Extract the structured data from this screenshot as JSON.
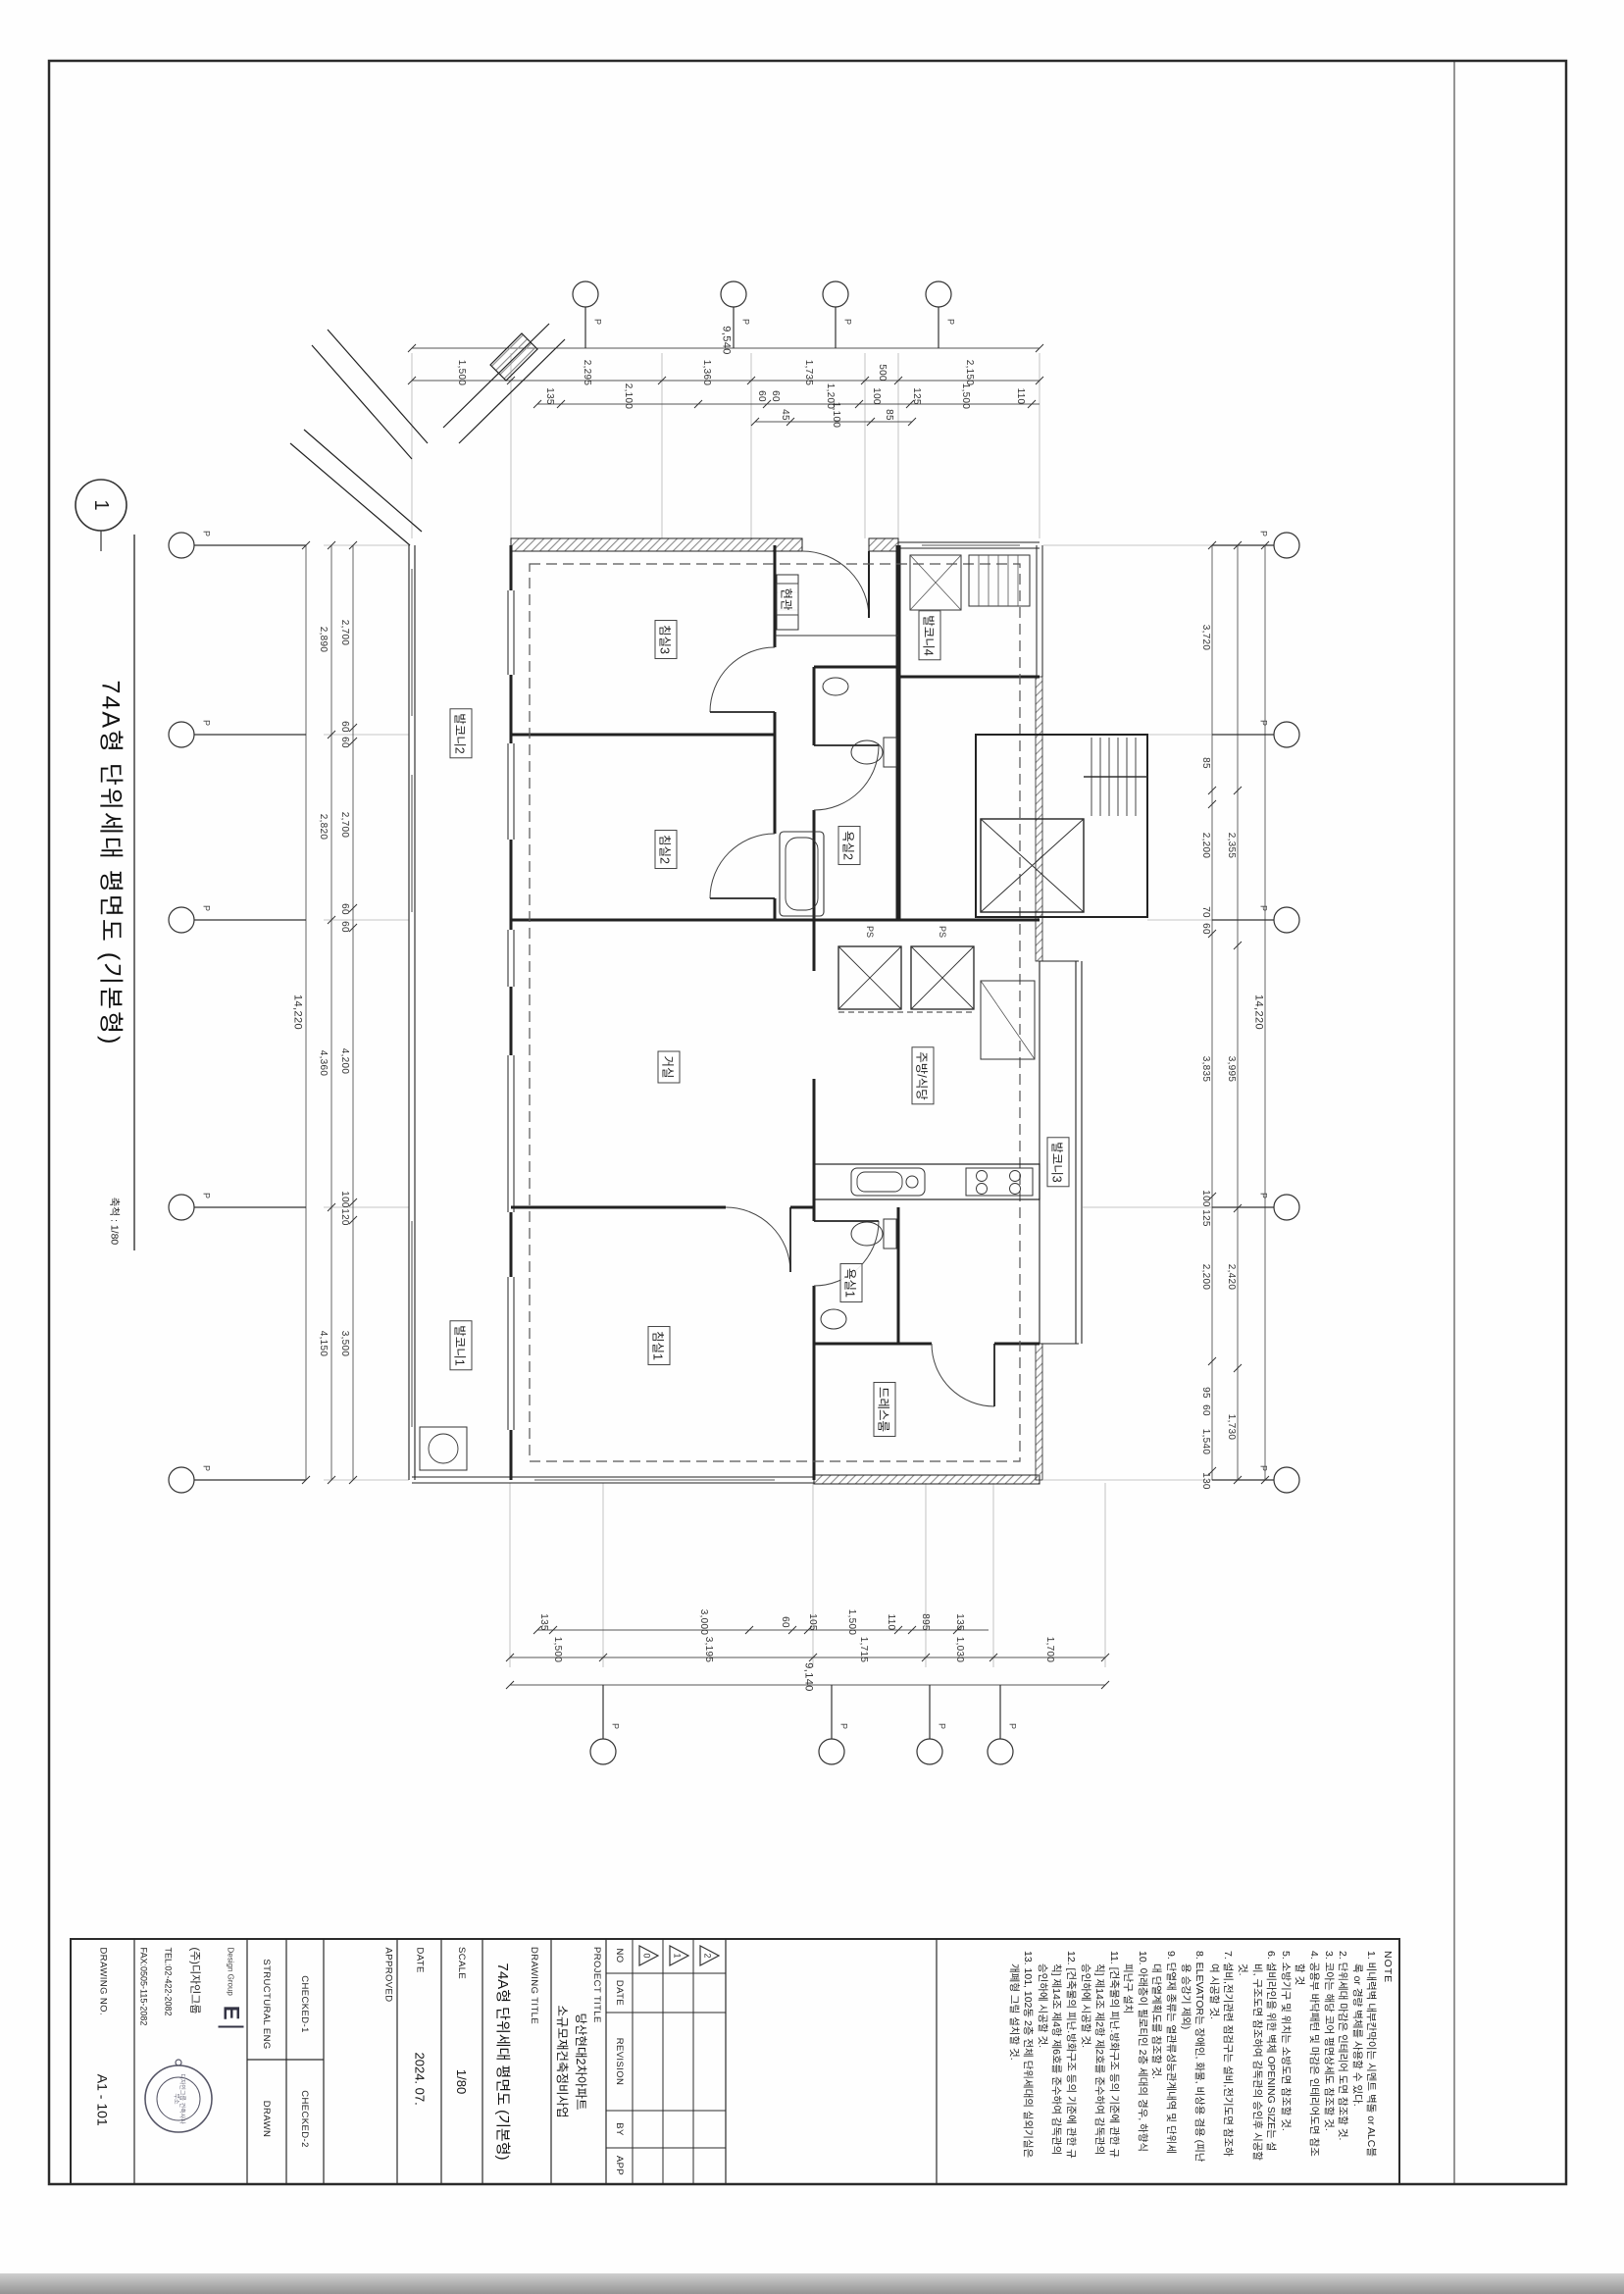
{
  "figure": {
    "number": "1",
    "title": "74A형 단위세대 평면도 (기본형)",
    "scale_note": "축척 : 1/80"
  },
  "grid": {
    "bubble_label": "P"
  },
  "rooms": [
    "침실3",
    "침실2",
    "거실",
    "침실1",
    "현관",
    "발코니4",
    "욕실2",
    "주방/식당",
    "발코니3",
    "욕실1",
    "드레스룸",
    "발코니2",
    "발코니1",
    "PS",
    "PS"
  ],
  "dims": {
    "t1": [
      "9,540"
    ],
    "t2": [
      "1,500",
      "2,295",
      "1,360",
      "1,735",
      "500",
      "2,150"
    ],
    "t3": [
      "135",
      "2,100",
      "60",
      "60",
      "1,200",
      "100",
      "125",
      "1,500",
      "110"
    ],
    "t4": [
      "45",
      "1,100",
      "85"
    ],
    "lt": [
      "14,220"
    ],
    "lo": [
      "2,890",
      "2,820",
      "4,360",
      "4,150"
    ],
    "li": [
      "2,700",
      "60",
      "60",
      "2,700",
      "60",
      "60",
      "4,200",
      "100",
      "120",
      "3,500"
    ],
    "rt": [
      "14,220"
    ],
    "ro": [
      "2,355",
      "3,995",
      "2,420",
      "1,730"
    ],
    "ri": [
      "3,720",
      "85",
      "2,200",
      "70",
      "60",
      "3,835",
      "100",
      "125",
      "2,200",
      "95",
      "60",
      "1,540",
      "130"
    ],
    "b1": [
      "135",
      "3,000",
      "60",
      "105",
      "1,500",
      "110",
      "895",
      "135"
    ],
    "b2": [
      "1,500",
      "3,195",
      "1,715",
      "1,030",
      "1,700"
    ],
    "b3": [
      "9,140"
    ]
  },
  "title_block": {
    "drawing_no_label": "DRAWING NO.",
    "drawing_no": "A1 - 101",
    "company": {
      "group_small": "Design Group",
      "logo": "E",
      "name": "(주)디자인그룹",
      "tel": "TEL:02-422-2082",
      "fax": "FAX:0505-115-2082",
      "stamp": "디자인그룹 건축사사무소"
    },
    "structural_label": "STRUCTURAL ENG",
    "drawn_label": "DRAWN",
    "checked1_label": "CHECKED-1",
    "checked2_label": "CHECKED-2",
    "approved_label": "APPROVED",
    "date_label": "DATE",
    "date_value": "2024. 07.",
    "scale_label": "SCALE",
    "scale_value": "1/80",
    "drawing_title_label": "DRAWING TITLE",
    "drawing_title": "74A형 단위세대 평면도 (기본형)",
    "project_title_label": "PROJECT TITLE",
    "project_title_line1": "당산현대2차아파트",
    "project_title_line2": "소규모재건축정비사업",
    "revision": {
      "no": "NO",
      "date": "DATE",
      "revision": "REVISION",
      "by": "BY",
      "app": "APP",
      "marks": [
        "0",
        "1",
        "2"
      ]
    }
  },
  "notes": {
    "header": "NOTE",
    "items": [
      "1. 비내력벽 내부칸막이는 시멘트 벽돌 or ALC블록 or 경량 벽체를 사용할 수 있다.",
      "2. 단위세대 마감은 인테리어 도면 참조할 것.",
      "3. 코아는 해당 코어 평면상세도 참조할 것.",
      "4. 공용부 바닥패턴 및 마감은 인테리어도면 참조할 것",
      "5. 소방기구 및 위치는 소방도면 참조할 것.",
      "6. 설비라인을 위한 벽체 OPENING SIZE는 설비, 구조도면 참조하여 감독관의 승인후 시공할 것.",
      "7. 설비,전기관련 점검구는 설비,전기도면 참조하여 시공할 것.",
      "8. ELEVATOR는 장애인, 화물, 비상용 겸용 (피난용 승강기 제외)",
      "9. 단열재 종류는 열관류성능관계내역 및 단위세대 단열계획도를 참조할 것.",
      "10. 아래층이 필로티인 2층 세대의 경우, 하향식 피난구 설치",
      "11. [건축물의 피난.방화구조 등의 기준에 관한 규칙] 제14조 제2항 제2호를 준수하여 감독관의 승인하에 시공할 것.",
      "12. [건축물의 피난.방화구조 등의 기준에 관한 규칙] 제14조 제4항 제6호를 준수하여 감독관의 승인하에 시공할 것.",
      "13. 101, 102동 2층 전체 단위세대의 실외기실은 개폐형 그릴 설치할 것."
    ]
  }
}
